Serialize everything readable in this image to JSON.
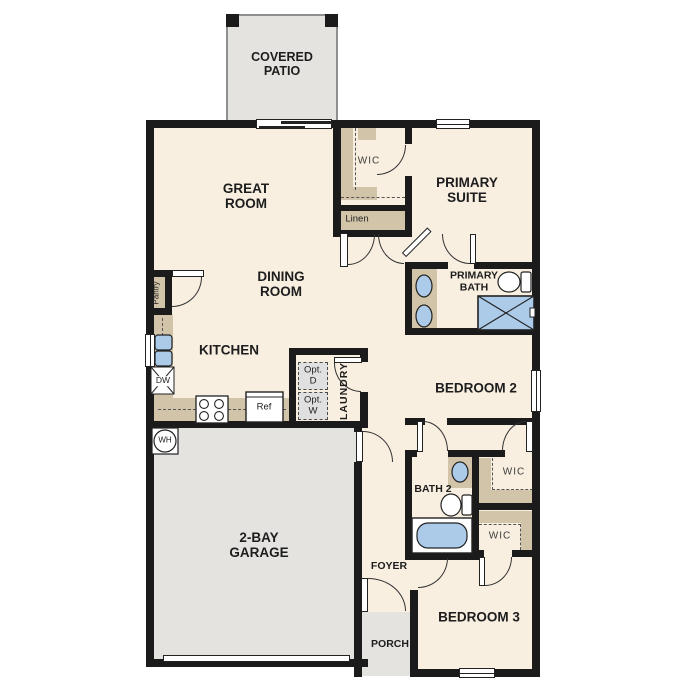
{
  "plan": {
    "type": "floor-plan",
    "labels": {
      "covered_patio": "COVERED PATIO",
      "great_room": "GREAT ROOM",
      "primary_suite": "PRIMARY SUITE",
      "primary_wic": "WIC",
      "linen": "Linen",
      "dining_room": "DINING ROOM",
      "primary_bath": "PRIMARY BATH",
      "pantry": "Pantry",
      "kitchen": "KITCHEN",
      "bedroom2": "BEDROOM 2",
      "opt_dryer": "Opt. D",
      "opt_washer": "Opt. W",
      "laundry": "LAUNDRY",
      "dishwasher": "DW",
      "refrigerator": "Ref",
      "water_heater": "WH",
      "bath2": "BATH 2",
      "bedroom2_wic": "WIC",
      "bedroom3_wic": "WIC",
      "garage": "2-BAY GARAGE",
      "foyer": "FOYER",
      "porch": "PORCH",
      "bedroom3": "BEDROOM 3"
    },
    "colors": {
      "interior": "#f8efe1",
      "outdoor": "#e4e3e0",
      "cabinet": "#d2c4a8",
      "fixture_blue": "#abcbe9",
      "wall": "#1b1b1b",
      "optional": "#e0e0e0"
    },
    "fixtures": [
      "kitchen-sink",
      "dishwasher",
      "range",
      "refrigerator",
      "water-heater",
      "pantry-cabinet",
      "optional-dryer",
      "optional-washer",
      "double-vanity-sinks",
      "toilet",
      "shower",
      "bathtub",
      "bath2-sink",
      "closet-shelving",
      "sliding-glass-door",
      "garage-door"
    ]
  }
}
